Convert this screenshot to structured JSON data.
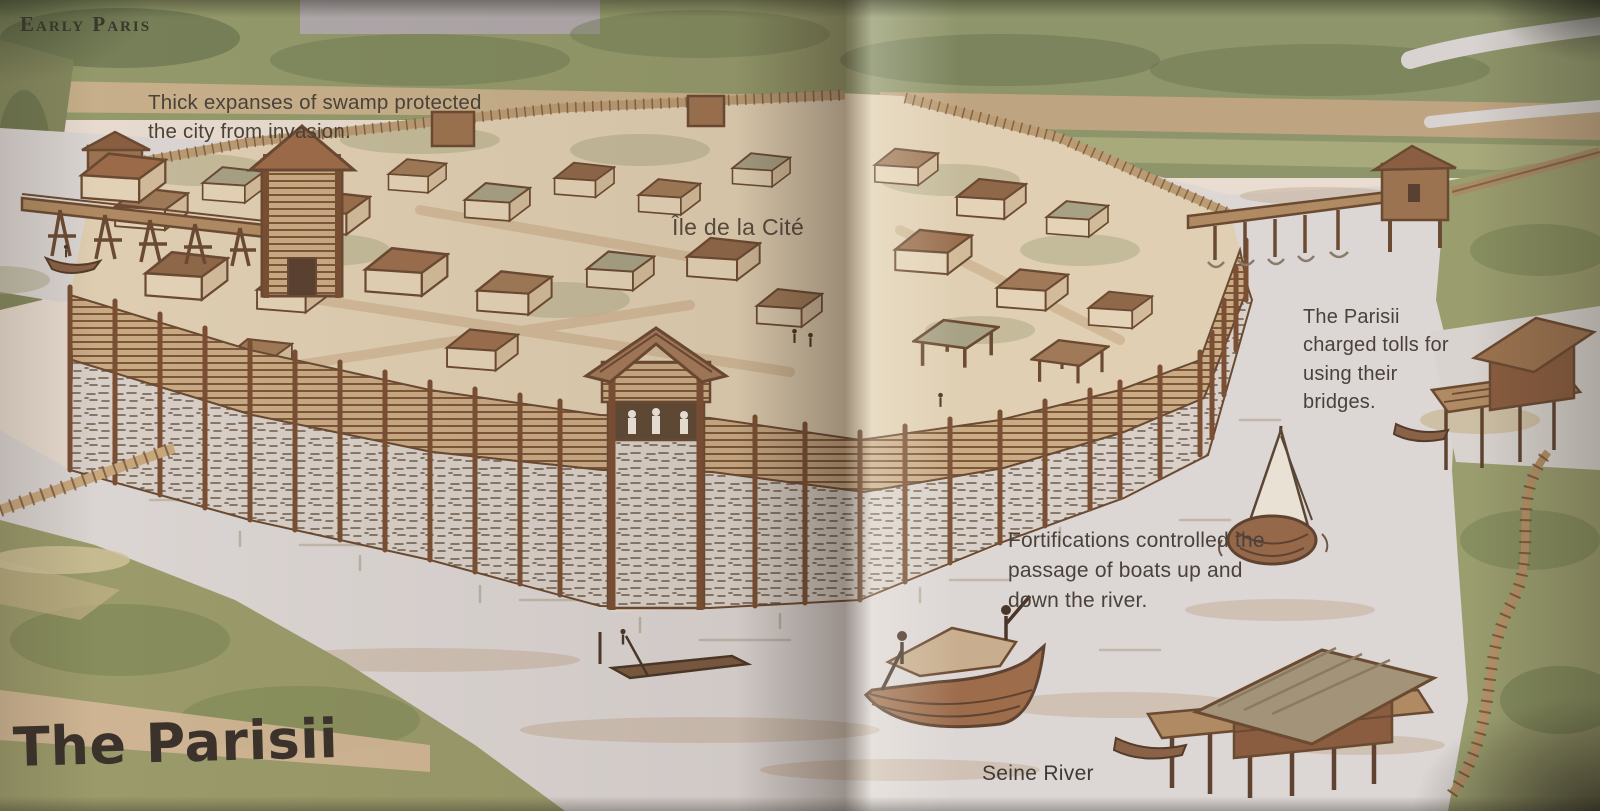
{
  "page": {
    "header_label": "Early Paris",
    "title": "The Parisii"
  },
  "labels": {
    "island": "Île de la Cité",
    "river": "Seine River"
  },
  "captions": {
    "swamp": "Thick expanses of swamp protected the city from invasion.",
    "tolls": "The Parisii charged tolls for using their bridges.",
    "fortifications": "Fortifications controlled the passage of boats up and down the river."
  },
  "illustration": {
    "type": "watercolor bird's-eye reconstruction of the fortified Parisii settlement on the Île de la Cité",
    "elements": [
      "palisade-wall",
      "gate-tower",
      "watchtower",
      "left-bridge",
      "right-bridge",
      "toll-house",
      "thatched-houses",
      "sailboat",
      "cargo-boat",
      "punt",
      "canoe",
      "stilt-house",
      "jetty-hut",
      "boardwalk",
      "marsh",
      "seine-river"
    ]
  },
  "colors": {
    "paper": "#e8ddd0",
    "island_ground": "#e0cfb2",
    "water": "#dcd6d4",
    "marsh_green": "#9a9c6c",
    "ink_brown": "#6b4a32",
    "roof_brown": "#a07a58",
    "stone": "#d8d0c8",
    "text": "#4a423a",
    "title_text": "#3a322b"
  }
}
